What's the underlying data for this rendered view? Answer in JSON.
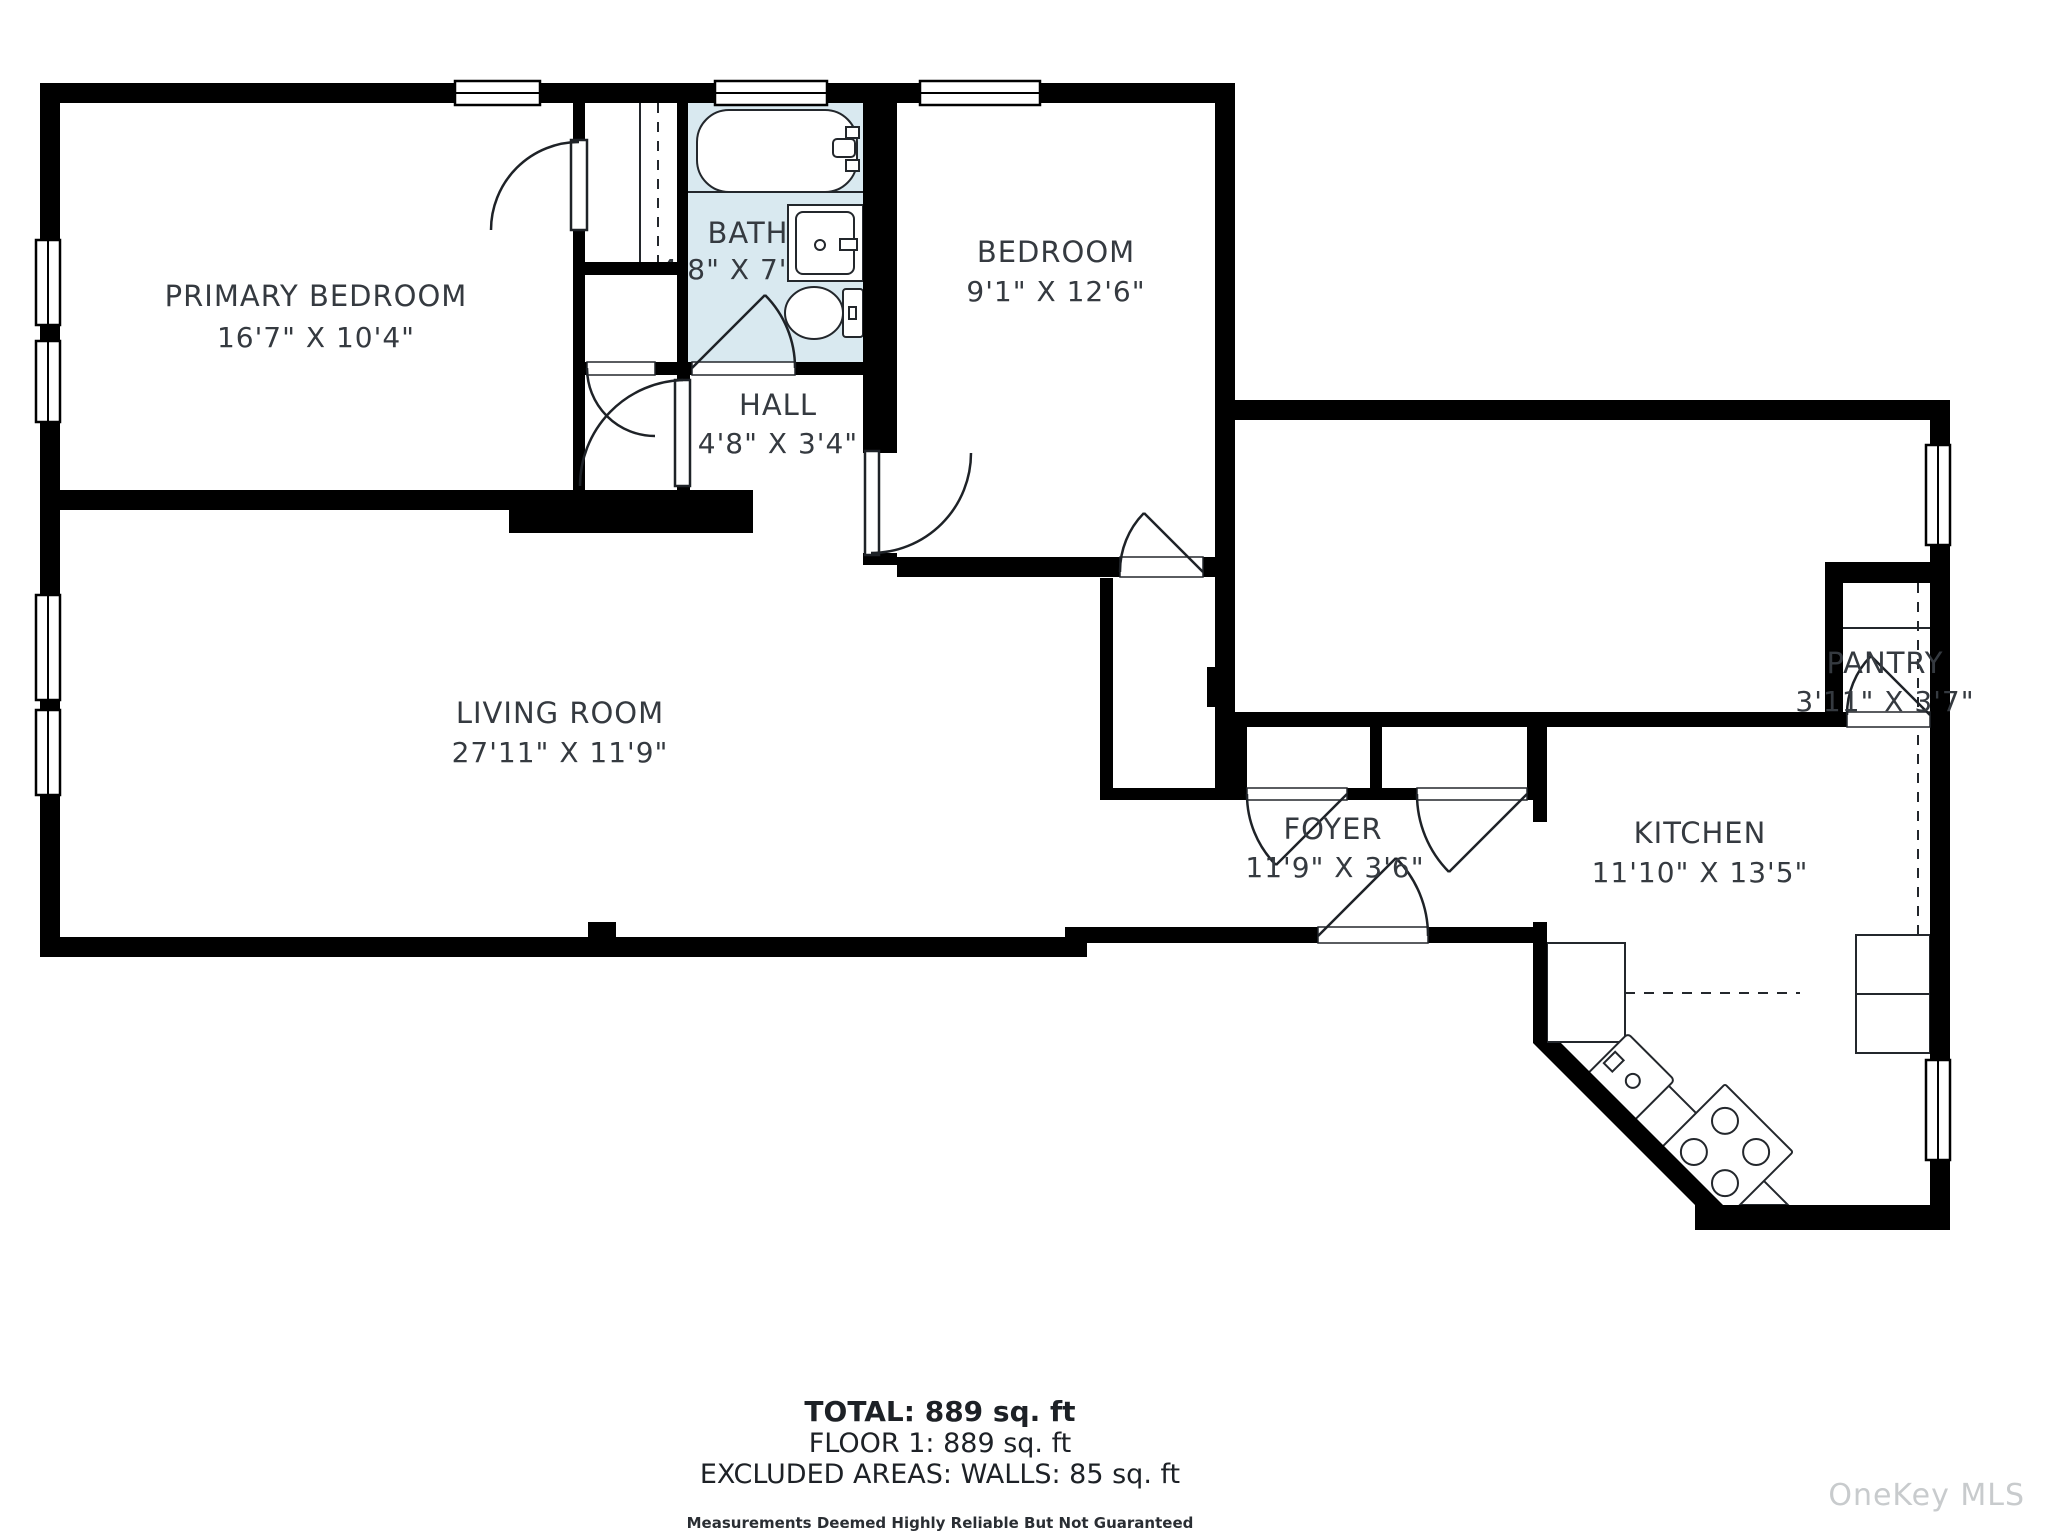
{
  "plan": {
    "colors": {
      "wall": "#000000",
      "bath_fill": "#d9e9f0",
      "label": "#353a40",
      "watermark": "#c8cbcd"
    },
    "rooms": {
      "primary_bedroom": {
        "name": "PRIMARY BEDROOM",
        "dims": "16'7\" X 10'4\""
      },
      "bath": {
        "name": "BATH",
        "dims": "4'8\" X 7'0\""
      },
      "hall": {
        "name": "HALL",
        "dims": "4'8\" X 3'4\""
      },
      "bedroom": {
        "name": "BEDROOM",
        "dims": "9'1\" X 12'6\""
      },
      "living_room": {
        "name": "LIVING ROOM",
        "dims": "27'11\" X 11'9\""
      },
      "foyer": {
        "name": "FOYER",
        "dims": "11'9\" X 3'6\""
      },
      "kitchen": {
        "name": "KITCHEN",
        "dims": "11'10\" X 13'5\""
      },
      "pantry": {
        "name": "PANTRY",
        "dims": "3'11\" X 3'7\""
      }
    }
  },
  "summary": {
    "total": "TOTAL: 889 sq. ft",
    "floor1": "FLOOR 1: 889 sq. ft",
    "excluded": "EXCLUDED AREAS: WALLS: 85 sq. ft",
    "disclaimer": "Measurements Deemed Highly Reliable But Not Guaranteed"
  },
  "watermark": "OneKey MLS"
}
